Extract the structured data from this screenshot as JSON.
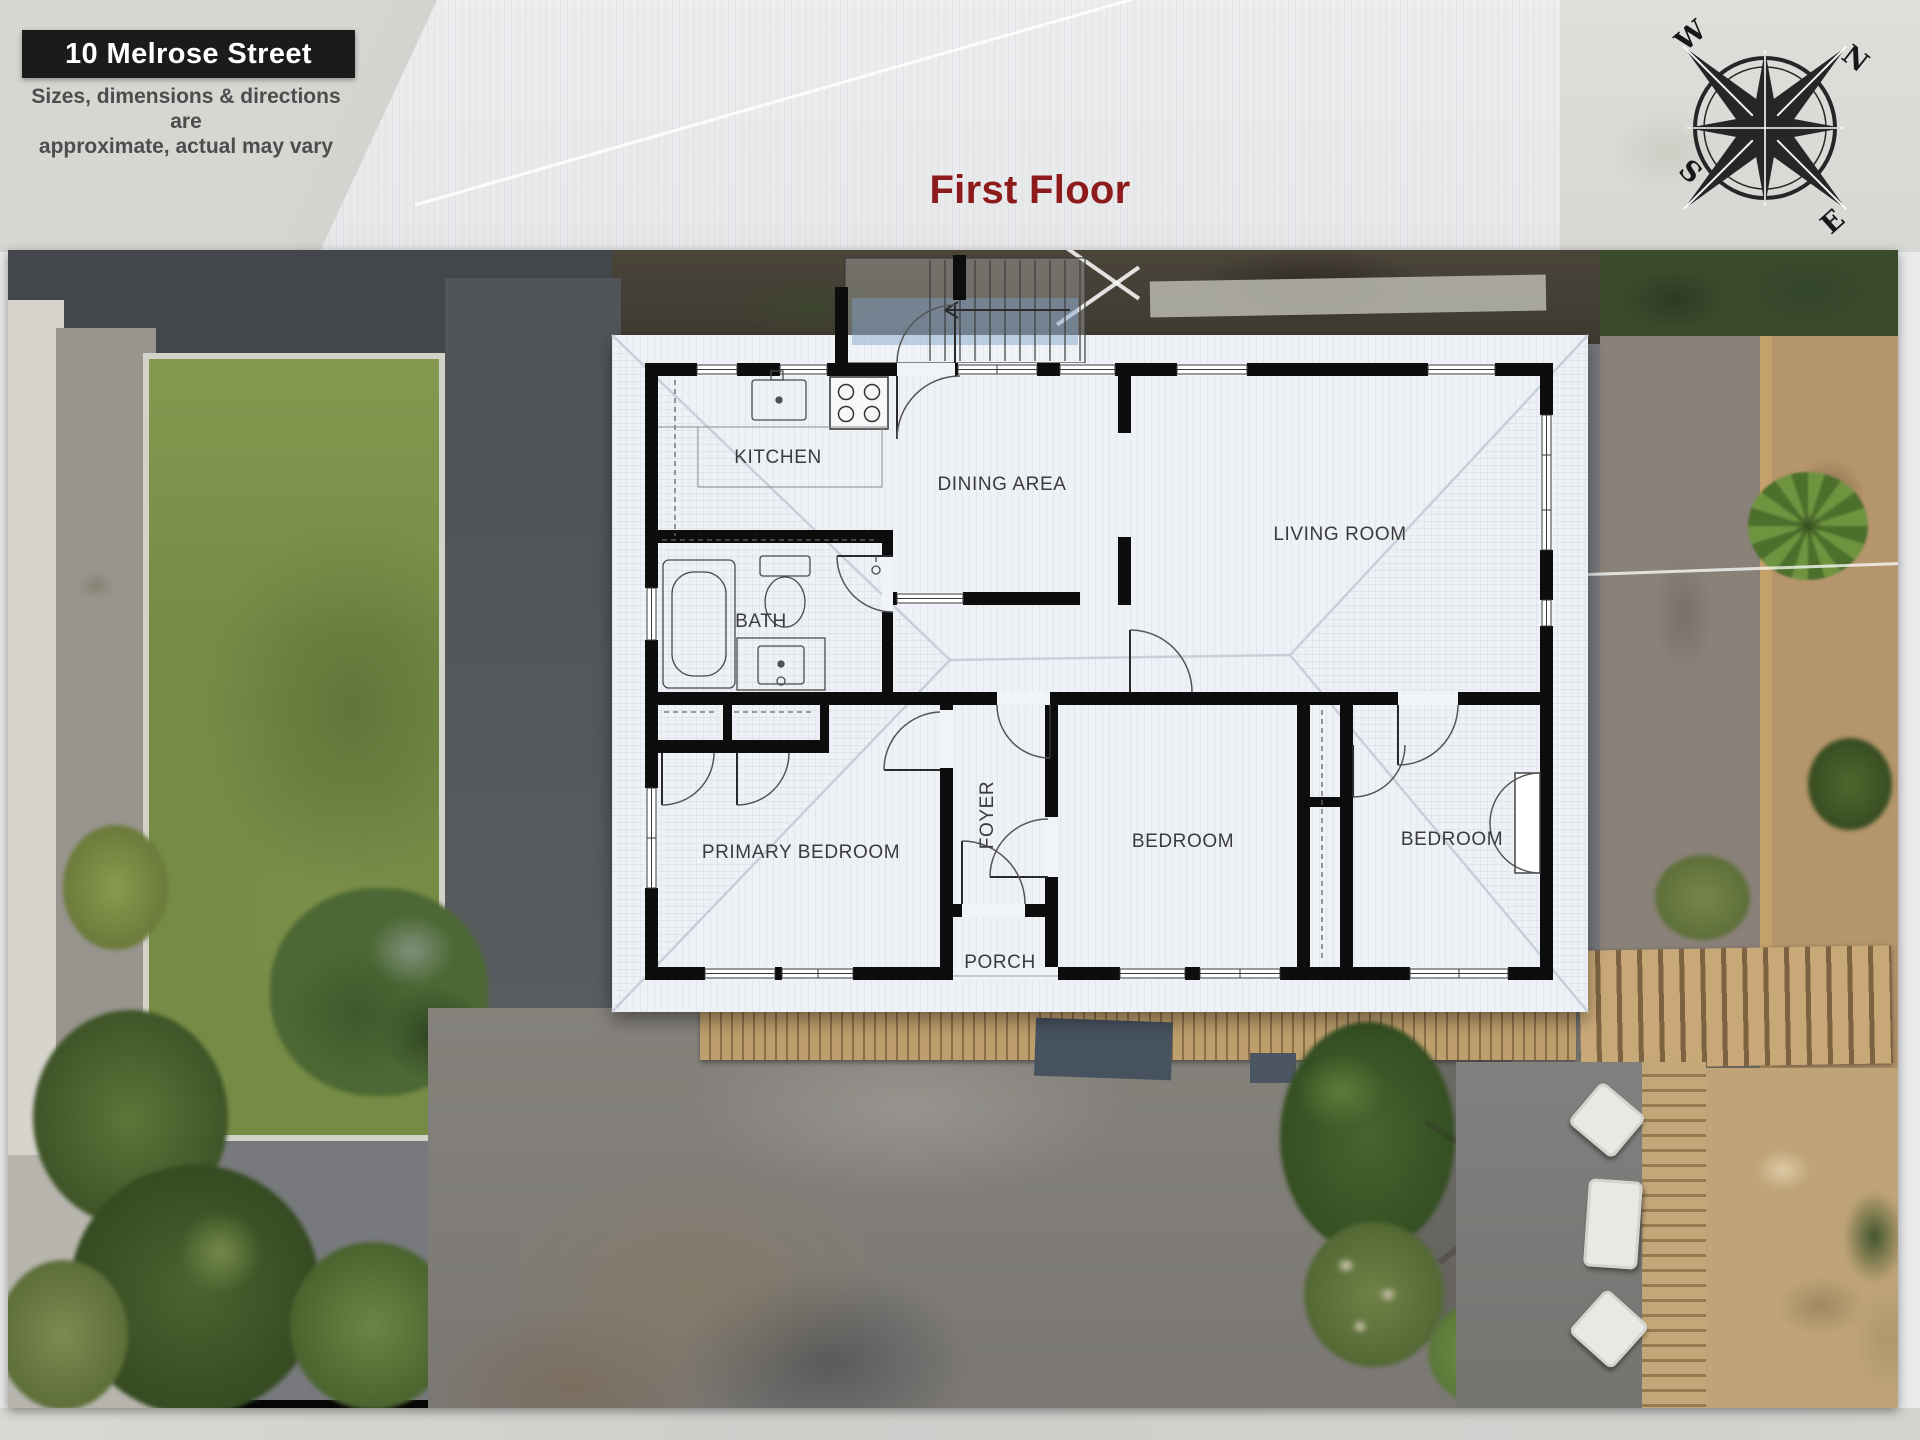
{
  "header": {
    "address": "10 Melrose Street",
    "disclaimer": [
      "Sizes, dimensions & directions are",
      "approximate, actual may vary"
    ],
    "floor_title": "First Floor"
  },
  "compass": {
    "north": "N",
    "east": "E",
    "south": "S",
    "west": "W"
  },
  "floorplan": {
    "rooms": [
      {
        "id": "kitchen",
        "label": "KITCHEN"
      },
      {
        "id": "dining-area",
        "label": "DINING AREA"
      },
      {
        "id": "living-room",
        "label": "LIVING ROOM"
      },
      {
        "id": "bath",
        "label": "BATH"
      },
      {
        "id": "foyer",
        "label": "FOYER"
      },
      {
        "id": "primary-bedroom",
        "label": "PRIMARY BEDROOM"
      },
      {
        "id": "bedroom-middle",
        "label": "BEDROOM"
      },
      {
        "id": "bedroom-right",
        "label": "BEDROOM"
      },
      {
        "id": "porch",
        "label": "PORCH"
      }
    ]
  },
  "colors": {
    "floor_title_red": "#8e1b1b",
    "banner_bg": "#111111",
    "banner_text": "#ffffff",
    "disclaimer_text": "#4d4d4d",
    "wall_black": "#0d0d0d",
    "roof_white": "#eef1f5",
    "lawn_green": "#768c46",
    "mulch_tan": "#b5956b",
    "asphalt_gray": "#43474b"
  }
}
